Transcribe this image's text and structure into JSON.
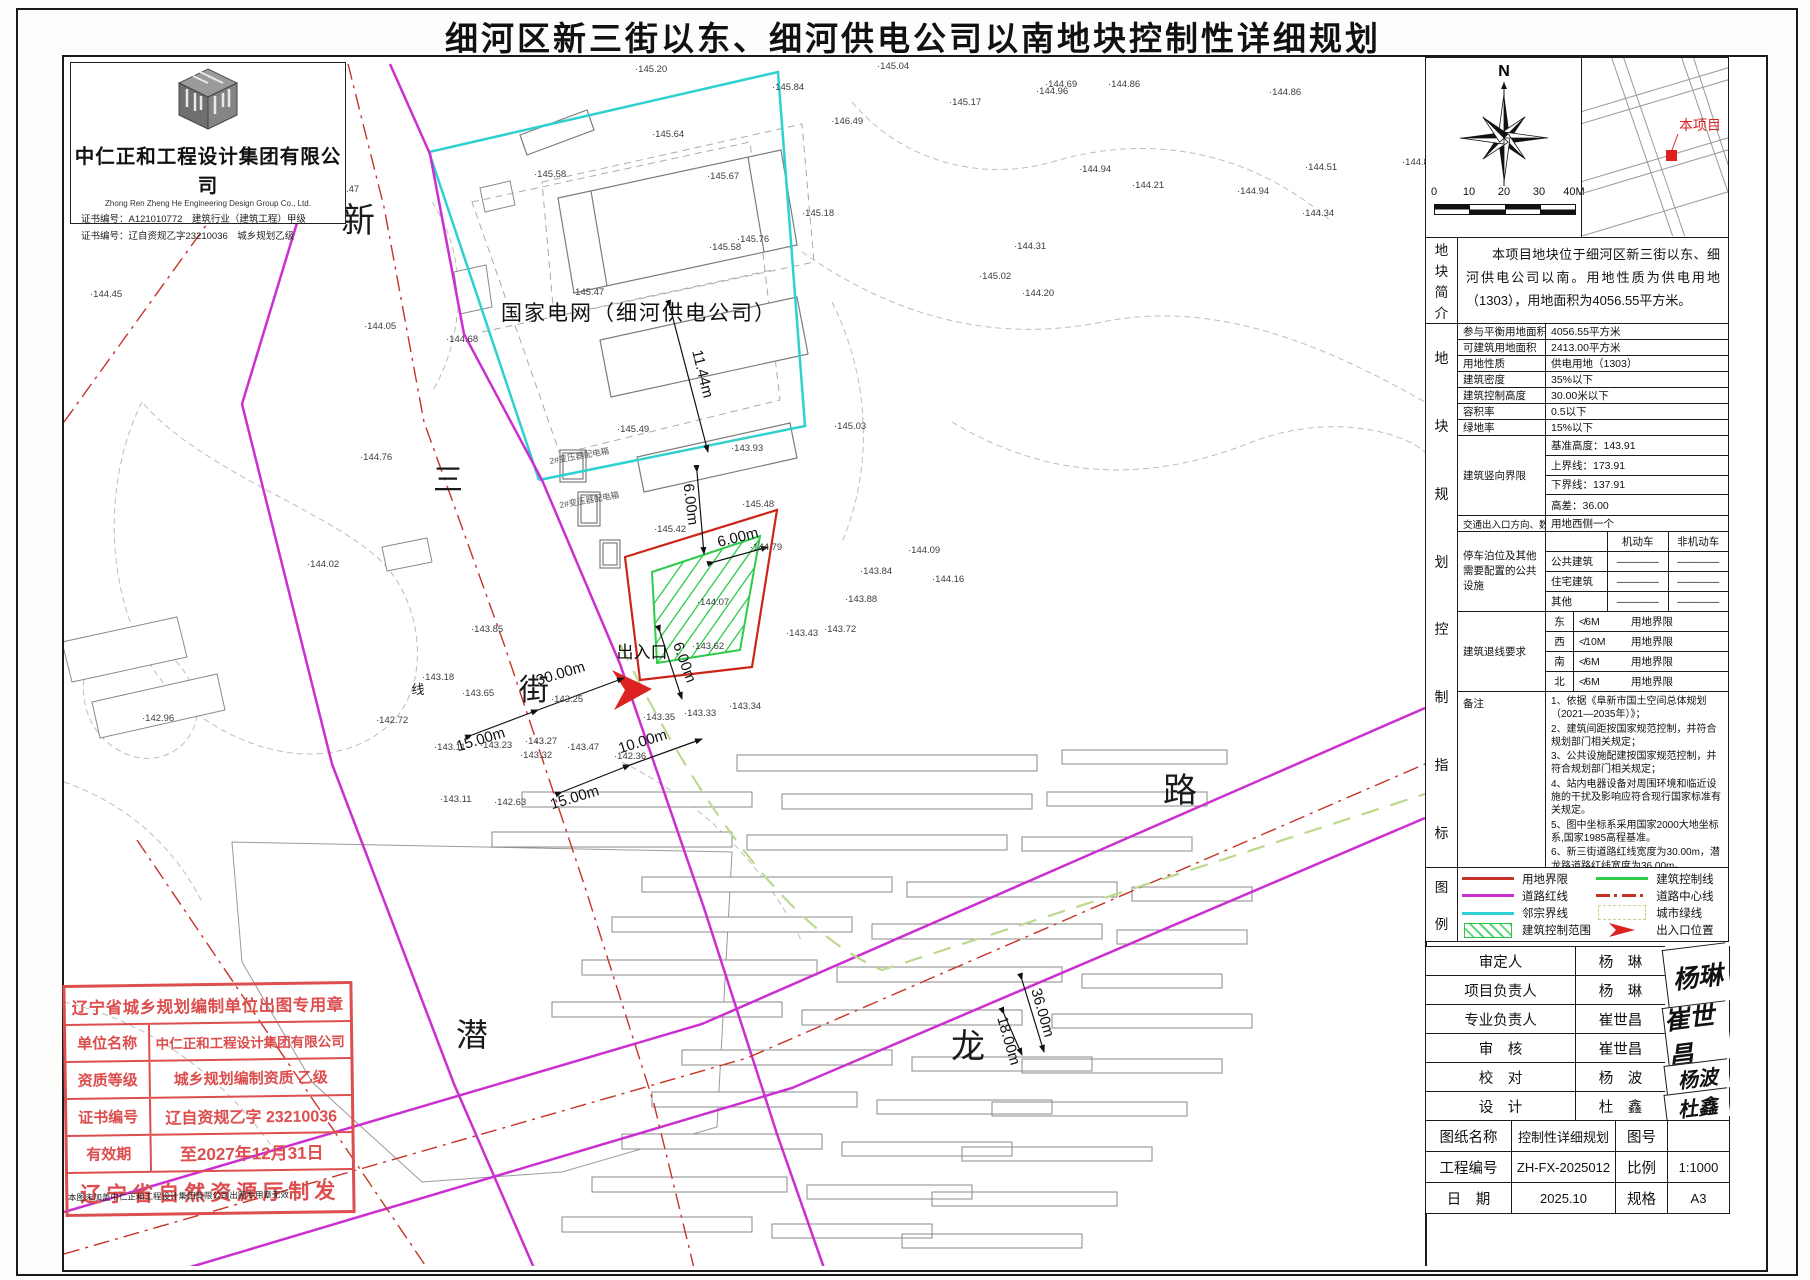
{
  "title": "细河区新三街以东、细河供电公司以南地块控制性详细规划",
  "company": {
    "name": "中仁正和工程设计集团有限公司",
    "name_en": "Zhong Ren Zheng He Engineering Design Group Co., Ltd.",
    "cert1": "证书编号：A121010772　建筑行业（建筑工程）甲级",
    "cert2": "证书编号：辽自资规乙字23210036　城乡规划乙级"
  },
  "compass": {
    "north_label": "N",
    "scale_ticks": [
      "0",
      "10",
      "20",
      "30",
      "40M"
    ]
  },
  "location_map": {
    "project_label": "本项目"
  },
  "intro": {
    "side_label": "地块简介",
    "text": "本项目地块位于细河区新三街以东、细河供电公司以南。用地性质为供电用地（1303），用地面积为4056.55平方米。"
  },
  "indicators": {
    "side_label": "地块规划控制指标",
    "rows": [
      {
        "k": "参与平衡用地面积",
        "v": "4056.55平方米"
      },
      {
        "k": "可建筑用地面积",
        "v": "2413.00平方米"
      },
      {
        "k": "用地性质",
        "v": "供电用地（1303）"
      },
      {
        "k": "建筑密度",
        "v": "35%以下"
      },
      {
        "k": "建筑控制高度",
        "v": "30.00米以下"
      },
      {
        "k": "容积率",
        "v": "0.5以下"
      },
      {
        "k": "绿地率",
        "v": "15%以下"
      }
    ],
    "vertical_limit": {
      "k": "建筑竖向界限",
      "items": [
        "基准高度：143.91",
        "上界线：173.91",
        "下界线：137.91",
        "高差：36.00"
      ]
    },
    "access": {
      "k": "交通出入口方向、数量",
      "v": "用地西侧一个"
    },
    "parking": {
      "k": "停车泊位及其他需要配置的公共设施",
      "cols": [
        "机动车",
        "非机动车"
      ],
      "rows": [
        {
          "k": "公共建筑",
          "v1": "————",
          "v2": "————"
        },
        {
          "k": "住宅建筑",
          "v1": "————",
          "v2": "————"
        },
        {
          "k": "其他",
          "v1": "————",
          "v2": "————"
        }
      ]
    },
    "setback": {
      "k": "建筑退线要求",
      "rows": [
        {
          "dir": "东",
          "req": "≮6M",
          "ref": "用地界限"
        },
        {
          "dir": "西",
          "req": "≮10M",
          "ref": "用地界限"
        },
        {
          "dir": "南",
          "req": "≮6M",
          "ref": "用地界限"
        },
        {
          "dir": "北",
          "req": "≮6M",
          "ref": "用地界限"
        }
      ]
    },
    "notes": {
      "k": "备注",
      "lines": [
        "1、依据《阜新市国土空间总体规划（2021—2035年）》；",
        "2、建筑间距按国家规范控制，并符合规划部门相关规定；",
        "3、公共设施配建按国家规范控制，并符合规划部门相关规定；",
        "4、站内电器设备对周围环境和临近设施的干扰及影响应符合现行国家标准有关规定。",
        "5、图中坐标系采用国家2000大地坐标系,国家1985高程基准。",
        "6、新三街道路红线宽度为30.00m，潜龙路道路红线宽度为36.00m。"
      ]
    }
  },
  "legend": {
    "side_label": "图例",
    "left": [
      {
        "label": "用地界限"
      },
      {
        "label": "道路红线"
      },
      {
        "label": "邻宗界线"
      },
      {
        "label": "建筑控制范围"
      }
    ],
    "right": [
      {
        "label": "建筑控制线"
      },
      {
        "label": "道路中心线"
      },
      {
        "label": "城市绿线"
      },
      {
        "label": "出入口位置"
      }
    ],
    "colors": {
      "boundary_red": "#c63326",
      "road_magenta": "#cc2fd0",
      "adjacent_cyan": "#2fd0d0",
      "control_green": "#27c943",
      "green_line": "#bcd98f",
      "entrance_red": "#dd2222"
    }
  },
  "sign_table": {
    "rows": [
      {
        "k": "审定人",
        "v": "杨　琳"
      },
      {
        "k": "项目负责人",
        "v": "杨　琳"
      },
      {
        "k": "专业负责人",
        "v": "崔世昌"
      },
      {
        "k": "审　核",
        "v": "崔世昌"
      },
      {
        "k": "校　对",
        "v": "杨　波"
      },
      {
        "k": "设　计",
        "v": "杜　鑫"
      }
    ],
    "signatures": [
      "杨琳",
      "崔世昌",
      "杨波",
      "杜鑫"
    ]
  },
  "info_table": {
    "rows": [
      {
        "k": "图纸名称",
        "v": "控制性详细规划",
        "k2": "图号",
        "v2": ""
      },
      {
        "k": "工程编号",
        "v": "ZH-FX-2025012",
        "k2": "比例",
        "v2": "1:1000"
      },
      {
        "k": "日　期",
        "v": "2025.10",
        "k2": "规格",
        "v2": "A3"
      }
    ]
  },
  "stamp": {
    "header": "辽宁省城乡规划编制单位出图专用章",
    "rows": [
      {
        "k": "单位名称",
        "v": "中仁正和工程设计集团有限公司"
      },
      {
        "k": "资质等级",
        "v": "城乡规划编制资质 乙级"
      },
      {
        "k": "证书编号",
        "v": "辽自资规乙字 23210036"
      },
      {
        "k": "有效期",
        "v": "至2027年12月31日"
      }
    ],
    "footer": "辽宁省自然资源厅制发",
    "disclaimer": "本图未加盖中仁正和工程设计集团有限公司出图专用章无效"
  },
  "map": {
    "site_label": "国家电网（细河供电公司）",
    "entrance_label": "出入口",
    "street_chars": [
      {
        "ch": "新",
        "x": 356,
        "y": 230,
        "size": 34
      },
      {
        "ch": "三",
        "x": 446,
        "y": 488,
        "size": 30
      },
      {
        "ch": "街",
        "x": 532,
        "y": 698,
        "size": 30
      },
      {
        "ch": "潜",
        "x": 470,
        "y": 1044,
        "size": 32
      },
      {
        "ch": "龙",
        "x": 966,
        "y": 1056,
        "size": 34
      },
      {
        "ch": "路",
        "x": 1178,
        "y": 800,
        "size": 34
      },
      {
        "ch": "线",
        "x": 416,
        "y": 692,
        "size": 13
      }
    ],
    "transformer_labels": [
      {
        "text": "2#变压器配电箱",
        "x": 548,
        "y": 462,
        "rot": -10
      },
      {
        "text": "2#变压器配电箱",
        "x": 558,
        "y": 506,
        "rot": -10
      }
    ],
    "dimensions": [
      {
        "label": "6.00m",
        "x": 684,
        "y": 503,
        "rot": 83
      },
      {
        "label": "11.44m",
        "x": 696,
        "y": 373,
        "rot": 76
      },
      {
        "label": "6.00m",
        "x": 737,
        "y": 540,
        "rot": -14
      },
      {
        "label": "6.00m",
        "x": 678,
        "y": 662,
        "rot": 70
      },
      {
        "label": "30.00m",
        "x": 560,
        "y": 676,
        "rot": -17
      },
      {
        "label": "15.00m",
        "x": 480,
        "y": 742,
        "rot": -17
      },
      {
        "label": "15.00m",
        "x": 574,
        "y": 800,
        "rot": -17
      },
      {
        "label": "10.00m",
        "x": 642,
        "y": 744,
        "rot": -17
      },
      {
        "label": "36.00m",
        "x": 1036,
        "y": 1012,
        "rot": 74
      },
      {
        "label": "18.00m",
        "x": 1002,
        "y": 1040,
        "rot": 74
      }
    ],
    "elevation_points": [
      {
        "x": 275,
        "y": 115,
        "v": "144.91"
      },
      {
        "x": 303,
        "y": 157,
        "v": "145.33"
      },
      {
        "x": 325,
        "y": 190,
        "v": "145.47"
      },
      {
        "x": 88,
        "y": 295,
        "v": "144.45"
      },
      {
        "x": 362,
        "y": 327,
        "v": "144.05"
      },
      {
        "x": 444,
        "y": 340,
        "v": "144.68"
      },
      {
        "x": 358,
        "y": 458,
        "v": "144.76"
      },
      {
        "x": 305,
        "y": 565,
        "v": "144.02"
      },
      {
        "x": 140,
        "y": 719,
        "v": "142.96"
      },
      {
        "x": 420,
        "y": 678,
        "v": "143.18"
      },
      {
        "x": 460,
        "y": 694,
        "v": "143.65"
      },
      {
        "x": 374,
        "y": 721,
        "v": "142.72"
      },
      {
        "x": 432,
        "y": 748,
        "v": "143.11"
      },
      {
        "x": 478,
        "y": 746,
        "v": "143.23"
      },
      {
        "x": 523,
        "y": 742,
        "v": "143.27"
      },
      {
        "x": 438,
        "y": 800,
        "v": "143.11"
      },
      {
        "x": 492,
        "y": 803,
        "v": "142.63"
      },
      {
        "x": 565,
        "y": 748,
        "v": "143.47"
      },
      {
        "x": 612,
        "y": 757,
        "v": "142.36"
      },
      {
        "x": 549,
        "y": 700,
        "v": "143.25"
      },
      {
        "x": 641,
        "y": 718,
        "v": "143.35"
      },
      {
        "x": 682,
        "y": 714,
        "v": "143.33"
      },
      {
        "x": 727,
        "y": 707,
        "v": "143.34"
      },
      {
        "x": 690,
        "y": 647,
        "v": "143.62"
      },
      {
        "x": 784,
        "y": 634,
        "v": "143.43"
      },
      {
        "x": 822,
        "y": 630,
        "v": "143.72"
      },
      {
        "x": 843,
        "y": 600,
        "v": "143.88"
      },
      {
        "x": 858,
        "y": 572,
        "v": "143.84"
      },
      {
        "x": 906,
        "y": 551,
        "v": "144.09"
      },
      {
        "x": 930,
        "y": 580,
        "v": "144.16"
      },
      {
        "x": 729,
        "y": 449,
        "v": "143.93"
      },
      {
        "x": 748,
        "y": 548,
        "v": "144.79"
      },
      {
        "x": 695,
        "y": 603,
        "v": "144.07"
      },
      {
        "x": 832,
        "y": 427,
        "v": "145.03"
      },
      {
        "x": 652,
        "y": 530,
        "v": "145.42"
      },
      {
        "x": 518,
        "y": 756,
        "v": "143.32"
      },
      {
        "x": 469,
        "y": 630,
        "v": "143.85"
      },
      {
        "x": 875,
        "y": 67,
        "v": "145.04"
      },
      {
        "x": 1034,
        "y": 92,
        "v": "144.96"
      },
      {
        "x": 947,
        "y": 103,
        "v": "145.17"
      },
      {
        "x": 1043,
        "y": 85,
        "v": "144.69"
      },
      {
        "x": 1106,
        "y": 85,
        "v": "144.86"
      },
      {
        "x": 829,
        "y": 122,
        "v": "146.49"
      },
      {
        "x": 800,
        "y": 214,
        "v": "145.18"
      },
      {
        "x": 1077,
        "y": 170,
        "v": "144.94"
      },
      {
        "x": 1130,
        "y": 186,
        "v": "144.21"
      },
      {
        "x": 1012,
        "y": 247,
        "v": "144.31"
      },
      {
        "x": 977,
        "y": 277,
        "v": "145.02"
      },
      {
        "x": 1020,
        "y": 294,
        "v": "144.20"
      },
      {
        "x": 1300,
        "y": 214,
        "v": "144.34"
      },
      {
        "x": 1267,
        "y": 93,
        "v": "144.86"
      },
      {
        "x": 1303,
        "y": 168,
        "v": "144.51"
      },
      {
        "x": 1400,
        "y": 163,
        "v": "144.88"
      },
      {
        "x": 1235,
        "y": 192,
        "v": "144.94"
      },
      {
        "x": 633,
        "y": 70,
        "v": "145.20"
      },
      {
        "x": 650,
        "y": 135,
        "v": "145.64"
      },
      {
        "x": 532,
        "y": 175,
        "v": "145.58"
      },
      {
        "x": 707,
        "y": 248,
        "v": "145.58"
      },
      {
        "x": 570,
        "y": 293,
        "v": "145.47"
      },
      {
        "x": 770,
        "y": 88,
        "v": "145.84"
      },
      {
        "x": 735,
        "y": 240,
        "v": "145.76"
      },
      {
        "x": 705,
        "y": 177,
        "v": "145.67"
      },
      {
        "x": 615,
        "y": 430,
        "v": "145.49"
      },
      {
        "x": 740,
        "y": 505,
        "v": "145.48"
      }
    ]
  }
}
